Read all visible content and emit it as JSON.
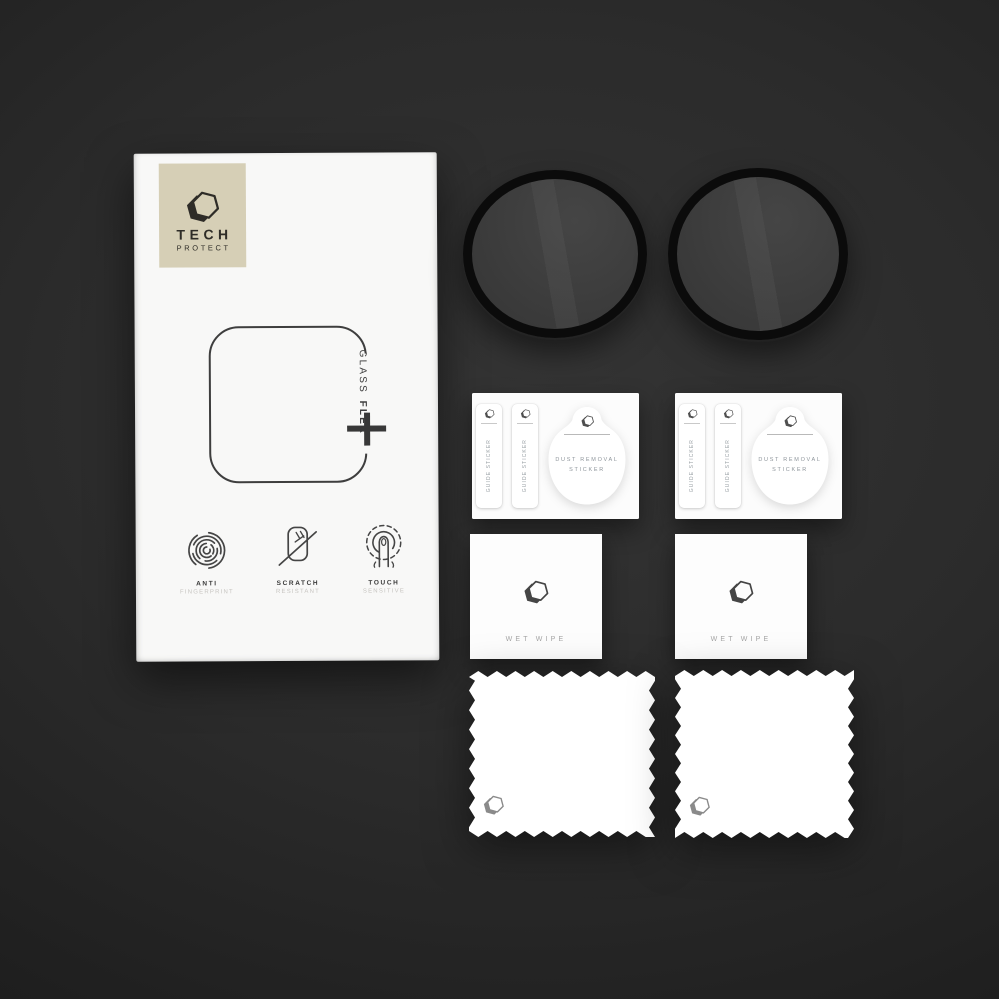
{
  "brand": {
    "name_top": "TECH",
    "name_bottom": "PROTECT"
  },
  "box": {
    "product_name_vertical": {
      "word1": "GLASS",
      "word2": "FLEX"
    },
    "features": [
      {
        "icon": "fingerprint-icon",
        "title": "ANTI",
        "subtitle": "FINGERPRINT"
      },
      {
        "icon": "scratch-resistant-icon",
        "title": "SCRATCH",
        "subtitle": "RESISTANT"
      },
      {
        "icon": "touch-sensitive-icon",
        "title": "TOUCH",
        "subtitle": "SENSITIVE"
      }
    ]
  },
  "accessories": {
    "glass_protectors": {
      "count": 2
    },
    "sticker_sheets": {
      "count": 2,
      "guide_sticker_label": "GUIDE STICKER",
      "dust_removal_line1": "DUST REMOVAL",
      "dust_removal_line2": "STICKER"
    },
    "wet_wipes": {
      "count": 2,
      "label": "WET WIPE"
    },
    "microfiber_cloths": {
      "count": 2
    }
  },
  "colors": {
    "background_center": "#343434",
    "background_edge": "#161616",
    "box_paper": "#f8f8f7",
    "badge": "#d6cfb6",
    "ink": "#3a3a3a",
    "muted_label": "#9aa0a5",
    "protector_ring": "#0b0b0b",
    "protector_glass": "#3d3d3d"
  }
}
